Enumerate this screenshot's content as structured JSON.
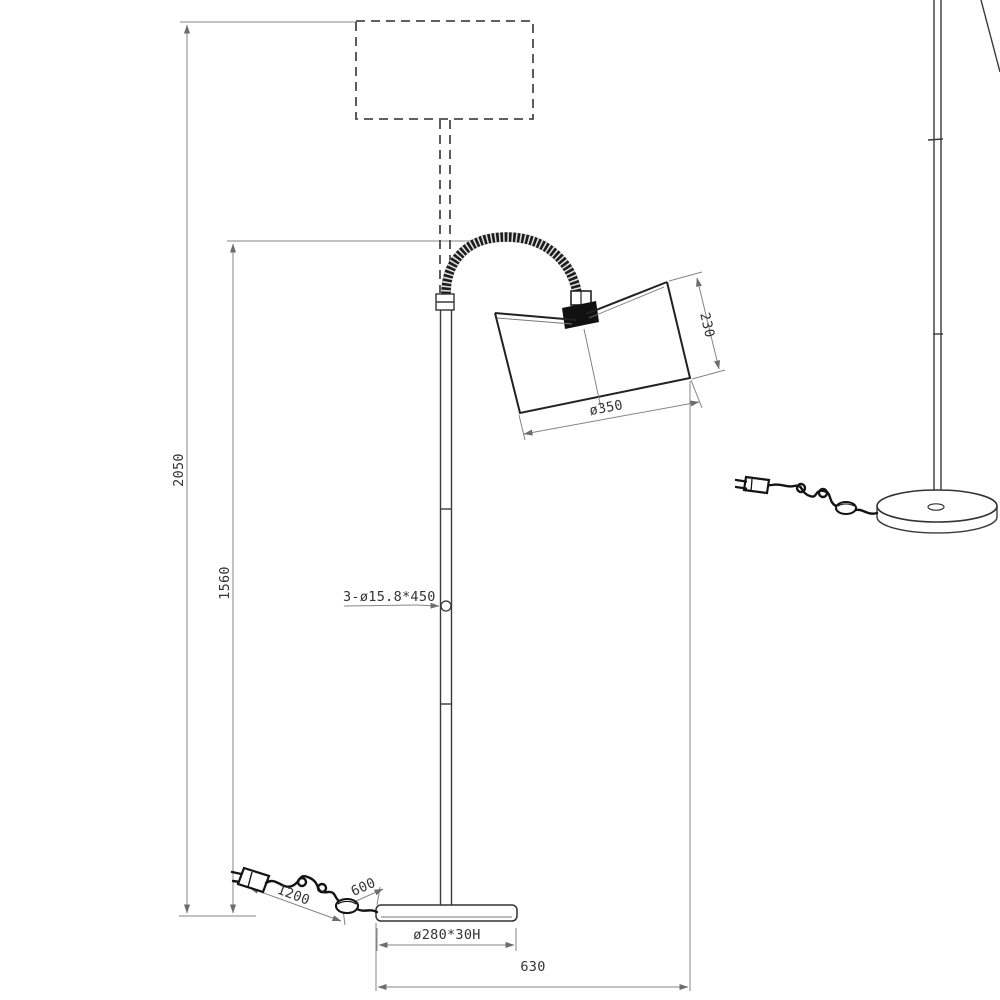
{
  "drawing": {
    "type": "technical-dimension-drawing",
    "subject": "arc floor lamp with flexible gooseneck, drum shade, round base, foot switch and power plug",
    "views": [
      "main-side-elevation-with-dimensions",
      "perspective-detail-view"
    ]
  },
  "labels": {
    "overall_height": "2050",
    "stand_height": "1560",
    "shade_depth": "230",
    "shade_diameter": "ø350",
    "tube_spec": "3-ø15.8*450",
    "cable_plug_to_switch": "1200",
    "cable_switch_to_base": "600",
    "base_spec": "ø280*30H",
    "horizontal_reach": "630"
  },
  "icons": {
    "plug": "power-plug-icon",
    "switch": "foot-switch-icon"
  },
  "colors": {
    "background": "#ffffff",
    "object_line": "#3a3a3a",
    "dimension_line": "#858585",
    "text": "#333333",
    "cord": "#141414"
  }
}
